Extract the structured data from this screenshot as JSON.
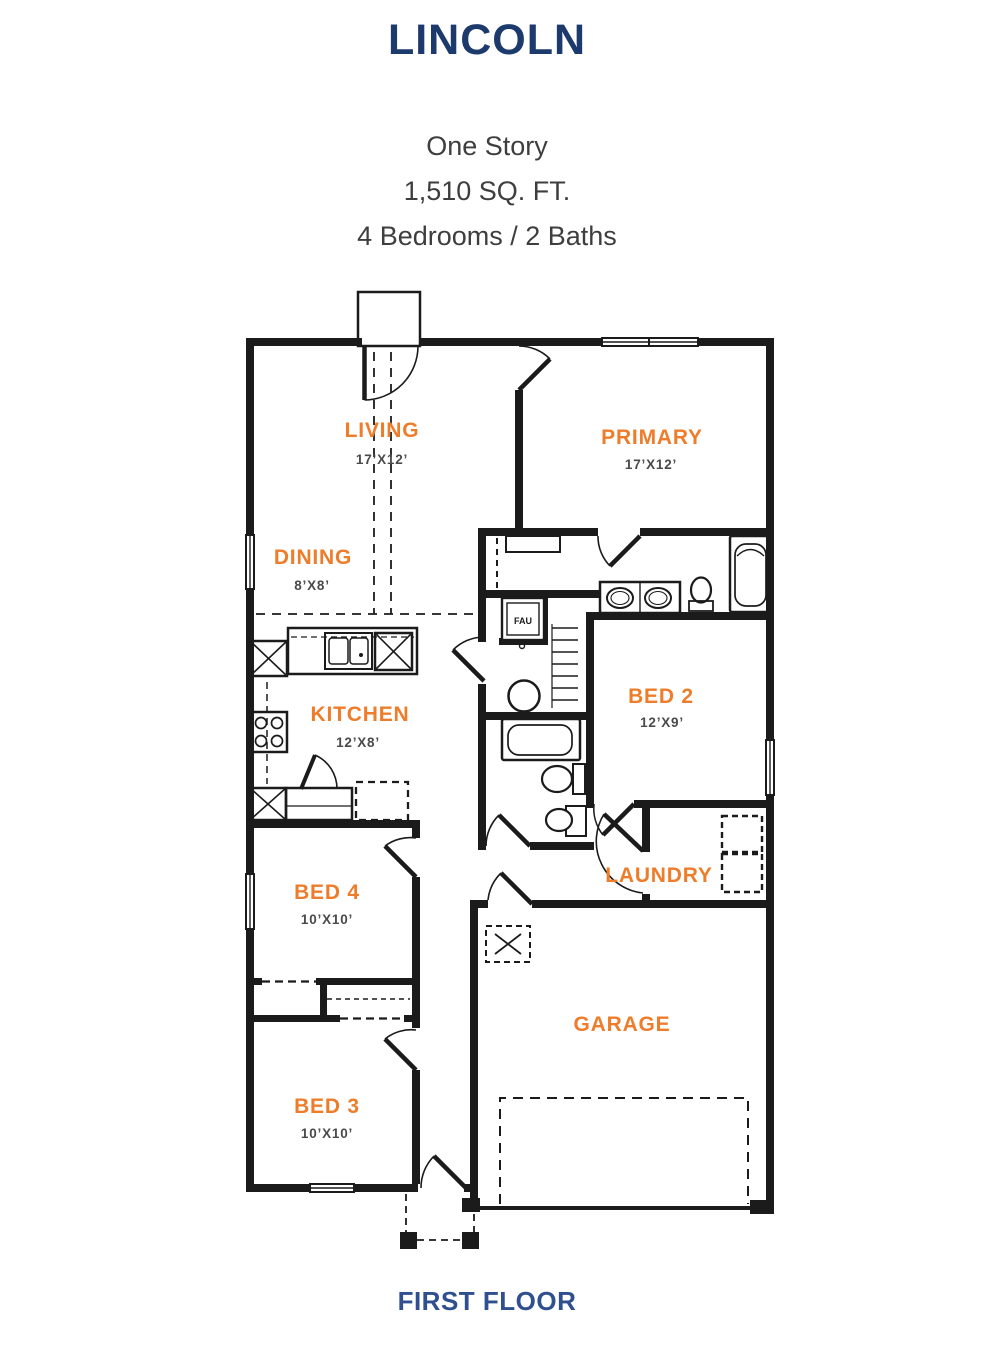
{
  "header": {
    "title": "LINCOLN",
    "subtitle_lines": {
      "story": "One Story",
      "sqft": "1,510 SQ. FT.",
      "beds_baths": "4 Bedrooms / 2 Baths"
    }
  },
  "rooms": [
    {
      "name": "LIVING",
      "dims": "17’X12’"
    },
    {
      "name": "PRIMARY",
      "dims": "17’X12’"
    },
    {
      "name": "DINING",
      "dims": "8’X8’"
    },
    {
      "name": "KITCHEN",
      "dims": "12’X8’"
    },
    {
      "name": "BED 2",
      "dims": "12’X9’"
    },
    {
      "name": "BED 4",
      "dims": "10’X10’"
    },
    {
      "name": "LAUNDRY",
      "dims": ""
    },
    {
      "name": "BED 3",
      "dims": "10’X10’"
    },
    {
      "name": "GARAGE",
      "dims": ""
    }
  ],
  "annotations": {
    "fau": "FAU"
  },
  "footer": {
    "label": "FIRST FLOOR"
  },
  "colors": {
    "title_navy": "#1d3a6d",
    "subtitle_gray": "#3e3e3e",
    "room_label_orange": "#ee7d2b",
    "dimension_gray": "#4a4a4a",
    "wall_black": "#1b1b1b",
    "floor_label_navy": "#2f4f8e"
  }
}
